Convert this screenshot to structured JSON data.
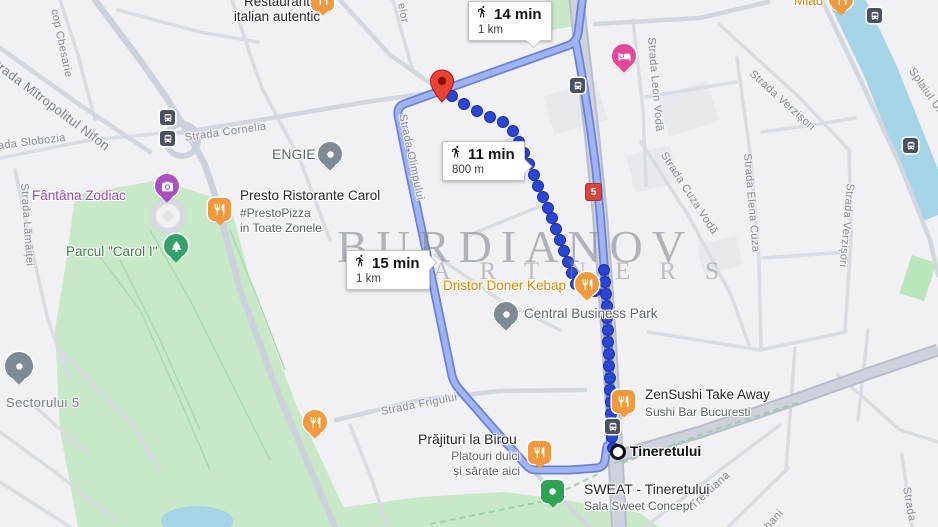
{
  "map": {
    "watermark": {
      "line1": "BURDIANOV",
      "line2": "PARTNERS"
    },
    "route_shield": "5",
    "bubbles": {
      "b14": {
        "time": "14 min",
        "distance": "1 km"
      },
      "b11": {
        "time": "11 min",
        "distance": "800 m"
      },
      "b15": {
        "time": "15 min",
        "distance": "1 km"
      }
    },
    "streets": {
      "chesarie": "cop Chesarie",
      "nifon": "Strada Mitropolitul Nifon",
      "slobozia": "Strada Slobozia",
      "lamaitei": "Strada Lămâiței",
      "cornelia": "Strada Cornelia",
      "elor": "elor",
      "olimpului": "Strada Olimpului",
      "frigului": "Strada Frigului",
      "leon_voda": "Strada Leon Vodă",
      "cuza_voda": "Strada Cuza Vodă",
      "elena_cuza": "Strada Elena Cuza",
      "verzisori_1": "Strada Verzișori",
      "verzisori_2": "Strada Verzișori",
      "splaiul": "Splaiul Unirii",
      "trestiana": "Trestiana",
      "hani": "hani",
      "strada_corner": "Strada",
      "sectorului": "Sectorului 5"
    },
    "pois": {
      "restaurant_italian": {
        "line1": "Restaurant",
        "line2": "italian autentic"
      },
      "engie": "ENGIE",
      "presto": {
        "name": "Presto Ristorante Carol",
        "sub1": "#PrestoPizza",
        "sub2": "in Toate Zonele"
      },
      "fantana": "Fântâna Zodiac",
      "parcul": "Parcul \"Carol I\"",
      "dristor": "Dristor Doner Kebap",
      "cbp": "Central Business Park",
      "zensushi": {
        "name": "ZenSushi Take Away",
        "sub": "Sushi Bar Bucuresti"
      },
      "tineretului": "Tineretului",
      "sweat": {
        "name": "SWEAT - Tineretului",
        "sub": "Sala Sweet Concept"
      },
      "prajituri": {
        "name": "Prăjituri la Birou",
        "sub1": "Platouri dulci",
        "sub2": "și sărate aici"
      },
      "miau": "Miau"
    },
    "colors": {
      "route_selected": "#2b46d2",
      "route_alt": "#a1b4f2",
      "destination_pin": "#ea4335",
      "restaurant_icon": "#f0993e",
      "park_green": "#c7e9c8",
      "water": "#a4d4e6"
    }
  }
}
